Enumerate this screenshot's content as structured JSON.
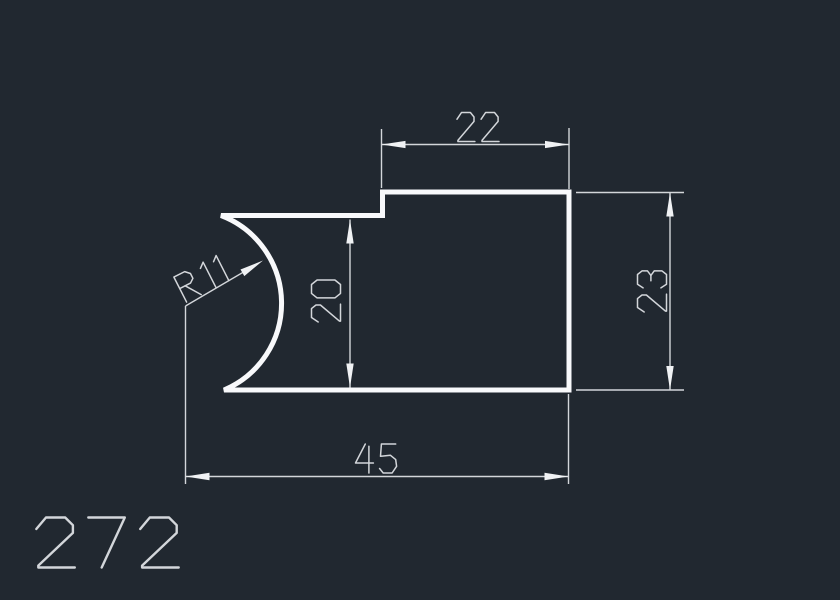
{
  "drawing": {
    "part_number": "272",
    "dimensions": {
      "top_width": "22",
      "right_height": "23",
      "left_height": "20",
      "total_width": "45",
      "radius": "R11"
    },
    "colors": {
      "background": "#212830",
      "outline": "#f8f9fb",
      "dimension": "#d3d6da",
      "text": "#d3d6da",
      "arrowhead": "#f0f2f4"
    }
  }
}
